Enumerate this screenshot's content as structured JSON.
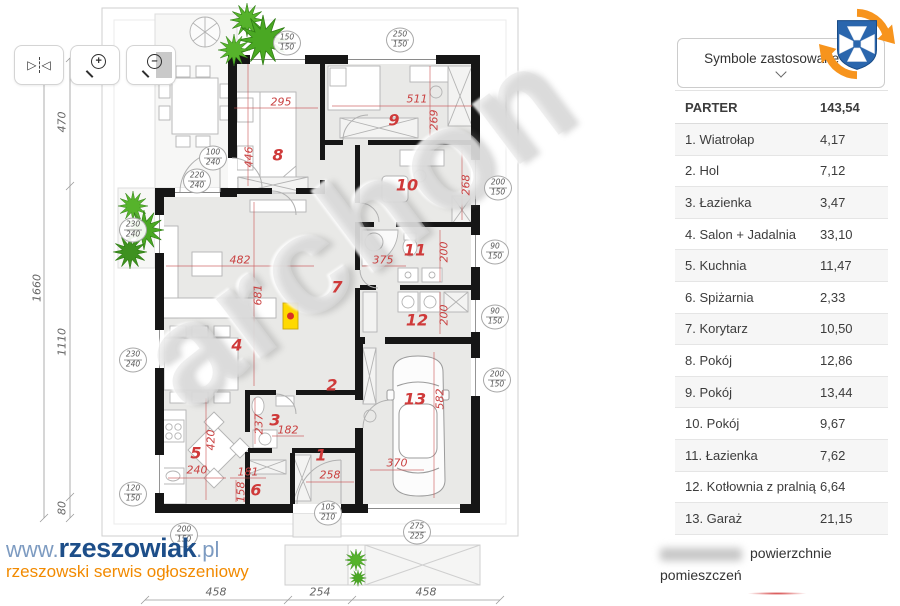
{
  "legend_dropdown": {
    "label": "Symbole zastosowane na"
  },
  "table": {
    "header": {
      "name": "PARTER",
      "value": "143,54"
    },
    "rows": [
      {
        "name": "1. Wiatrołap",
        "value": "4,17"
      },
      {
        "name": "2. Hol",
        "value": "7,12"
      },
      {
        "name": "3. Łazienka",
        "value": "3,47"
      },
      {
        "name": "4. Salon + Jadalnia",
        "value": "33,10"
      },
      {
        "name": "5. Kuchnia",
        "value": "11,47"
      },
      {
        "name": "6. Spiżarnia",
        "value": "2,33"
      },
      {
        "name": "7. Korytarz",
        "value": "10,50"
      },
      {
        "name": "8. Pokój",
        "value": "12,86"
      },
      {
        "name": "9. Pokój",
        "value": "13,44"
      },
      {
        "name": "10. Pokój",
        "value": "9,67"
      },
      {
        "name": "11. Łazienka",
        "value": "7,62"
      },
      {
        "name": "12. Kotłownia z pralnią",
        "value": "6,64"
      },
      {
        "name": "13. Garaż",
        "value": "21,15"
      }
    ]
  },
  "footer": {
    "note_line1": "powierzchnie",
    "note_line2": "pomieszczeń"
  },
  "brand": {
    "prefix": "www.",
    "name": "rzeszowiak",
    "suffix": ".pl",
    "tagline": "rzeszowski serwis ogłoszeniowy"
  },
  "toolbar": {
    "icons": [
      "flip-horizontal",
      "zoom-in",
      "zoom-out"
    ],
    "flip_left_glyph": "▷",
    "flip_right_glyph": "◁",
    "zoom_in_glyph": "+",
    "zoom_out_glyph": "–"
  },
  "plan": {
    "watermark": "archon",
    "room_numbers": [
      "1",
      "2",
      "3",
      "4",
      "5",
      "6",
      "7",
      "8",
      "9",
      "10",
      "11",
      "12",
      "13"
    ],
    "dims": [
      "295",
      "446",
      "511",
      "269",
      "268",
      "375",
      "200",
      "200",
      "482",
      "681",
      "237",
      "182",
      "258",
      "240",
      "420",
      "181",
      "158",
      "370",
      "582"
    ],
    "window_tags": [
      {
        "top": "150",
        "bottom": "150"
      },
      {
        "top": "250",
        "bottom": "150"
      },
      {
        "top": "100",
        "bottom": "240"
      },
      {
        "top": "220",
        "bottom": "240"
      },
      {
        "top": "230",
        "bottom": "240"
      },
      {
        "top": "230",
        "bottom": "240"
      },
      {
        "top": "120",
        "bottom": "150"
      },
      {
        "top": "200",
        "bottom": "150"
      },
      {
        "top": "90",
        "bottom": "150"
      },
      {
        "top": "90",
        "bottom": "150"
      },
      {
        "top": "200",
        "bottom": "150"
      },
      {
        "top": "105",
        "bottom": "210"
      },
      {
        "top": "275",
        "bottom": "225"
      },
      {
        "top": "200",
        "bottom": "150"
      }
    ],
    "outer_dims": {
      "left": [
        "470",
        "1660",
        "1110",
        "80"
      ],
      "bottom": [
        "458",
        "254",
        "458"
      ]
    }
  },
  "colors": {
    "dim_red": "#c94040",
    "wall_black": "#161616",
    "tree_green": "#56b32b",
    "brand_blue": "#1d4e89",
    "brand_orange": "#f28a00",
    "boiler_yellow": "#ffd900"
  }
}
